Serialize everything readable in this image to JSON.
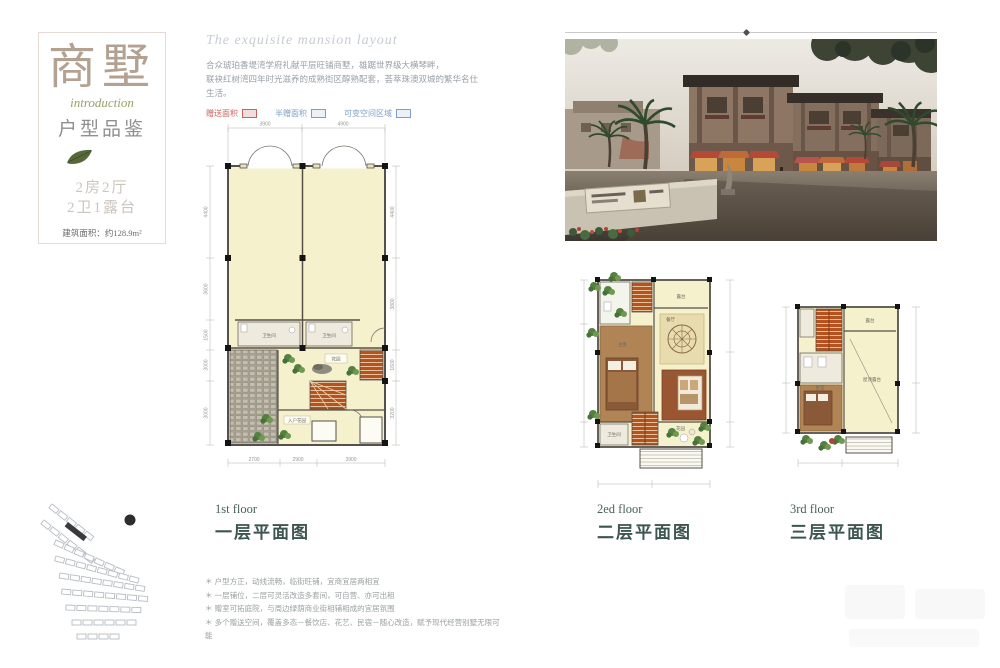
{
  "banner": {
    "title": "商墅",
    "script": "introduction",
    "subtitle": "户型品鉴",
    "spec1": "2房2厅",
    "spec2": "2卫1露台",
    "area": "建筑面积：约128.9m²"
  },
  "intro": {
    "script_heading": "The exquisite mansion layout",
    "desc1": "合众琥珀香堤湾学府礼献平层旺铺商墅，雄踞世界级大横琴畔，",
    "desc2": "联袂红树湾四年时光滋养的成熟街区醇熟配套，荟萃珠澳双城的繁华名仕生活。",
    "legend": [
      {
        "label": "赠送面积",
        "color": "#c9625a"
      },
      {
        "label": "半赠面积",
        "color": "#7b9fc7"
      },
      {
        "label": "可变空间区域",
        "color": "#7b9fc7"
      }
    ]
  },
  "floor_labels": [
    {
      "en": "1st floor",
      "cn": "一层平面图"
    },
    {
      "en": "2ed floor",
      "cn": "二层平面图"
    },
    {
      "en": "3rd floor",
      "cn": "三层平面图"
    }
  ],
  "plan1": {
    "dims_top": [
      "3900",
      "4900"
    ],
    "dims_bottom": [
      "2700",
      "2900",
      "3900"
    ],
    "dims_left": [
      "4400",
      "3600",
      "1500",
      "3000",
      "3000"
    ],
    "dims_right": [
      "4400",
      "3800",
      "1600",
      "3200"
    ],
    "rooms": {
      "bath1": "卫生间",
      "bath2": "卫生间",
      "garden": "花园",
      "entry": "入户花园"
    }
  },
  "plan2": {
    "rooms": {
      "terrace": "露台",
      "dining": "餐厅",
      "living": "客厅",
      "bedroom": "主卧",
      "bath": "卫生间",
      "garden": "花园"
    }
  },
  "plan3": {
    "rooms": {
      "terrace": "露台",
      "bigroom": "屋顶露台",
      "bedroom": "卧室"
    }
  },
  "notes": [
    "＊ 户型方正，动线流畅，临街旺铺，宜商宜居两相宜",
    "＊ 一层铺位，二层可灵活改造多套间，可自营、亦可出租",
    "＊ 赠室可拓庭院，与周边绿荫商业街相辅相成的宜居氛围",
    "＊ 多个赠送空间，覆盖多态－餐饮店、花艺、民宿－随心改造，赋予现代经营别墅无限可能"
  ],
  "colors": {
    "accent_red": "#c9625a",
    "accent_blue": "#7b9fc7",
    "plan_fill": "#f6f1cd",
    "stair_orange": "#b5521f",
    "label_teal": "#3c5550"
  }
}
